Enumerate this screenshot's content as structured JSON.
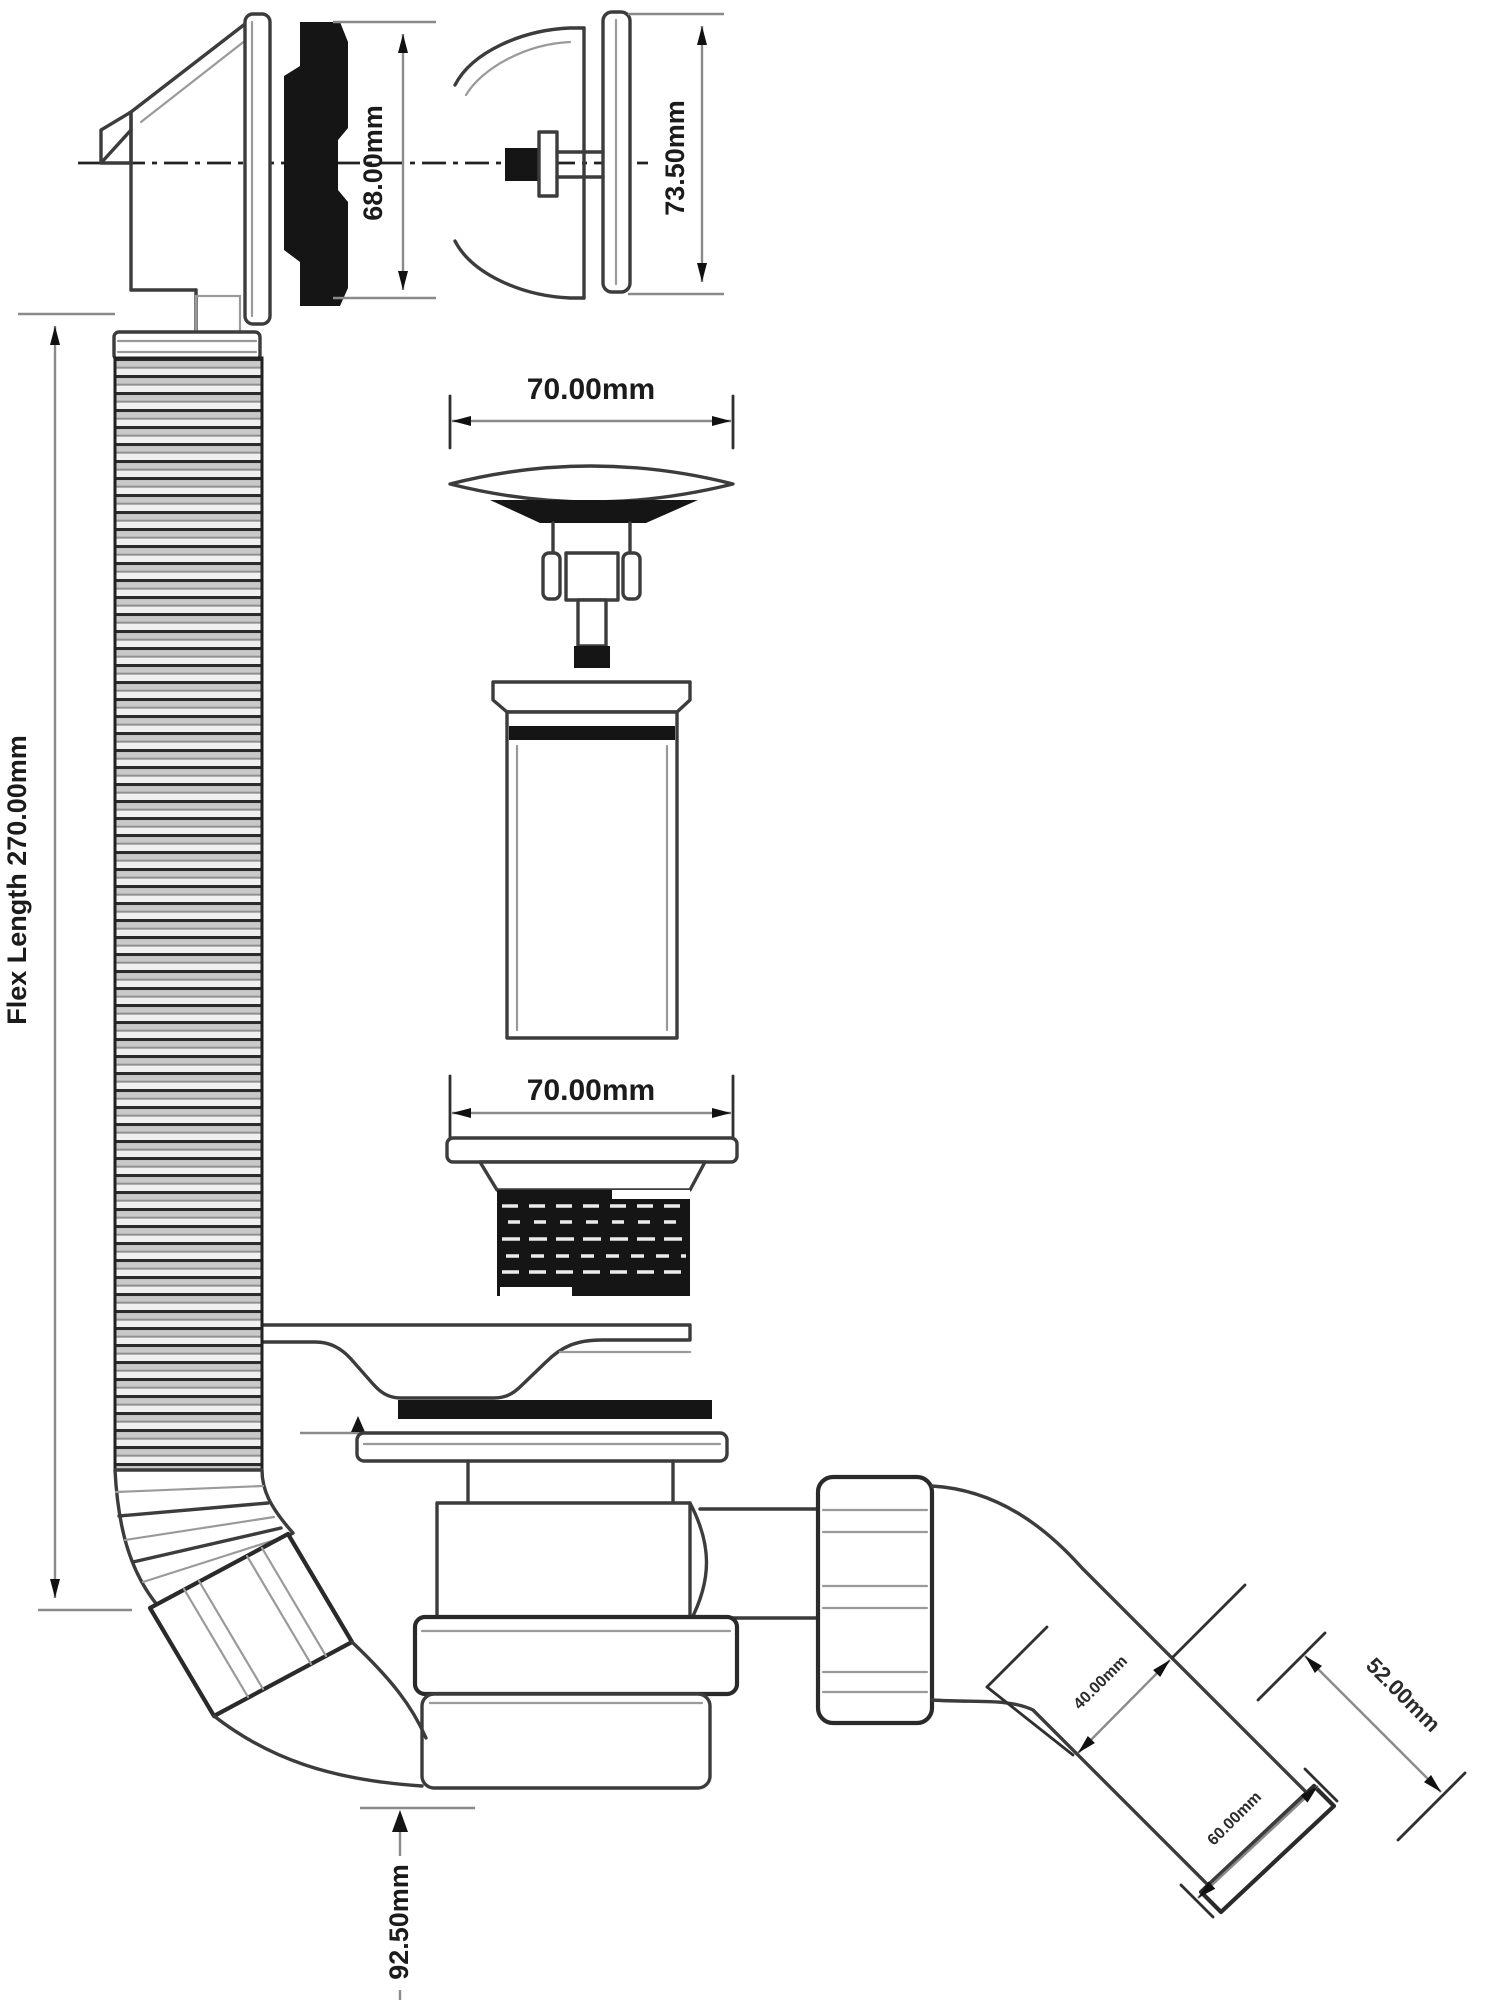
{
  "labels": {
    "flex_length": "Flex Length 270.00mm",
    "overflow_height": "68.00mm",
    "overflow_plate_height": "73.50mm",
    "plug_diameter": "70.00mm",
    "flange_diameter": "70.00mm",
    "trap_depth": "92.50mm",
    "outlet_bore": "40.00mm",
    "outlet_length": "60.00mm",
    "outlet_diameter": "52.00mm"
  },
  "colors": {
    "outline": "#3c3c3c",
    "dim_line": "#8a8a8a",
    "black_fill": "#151515",
    "background": "#ffffff"
  }
}
